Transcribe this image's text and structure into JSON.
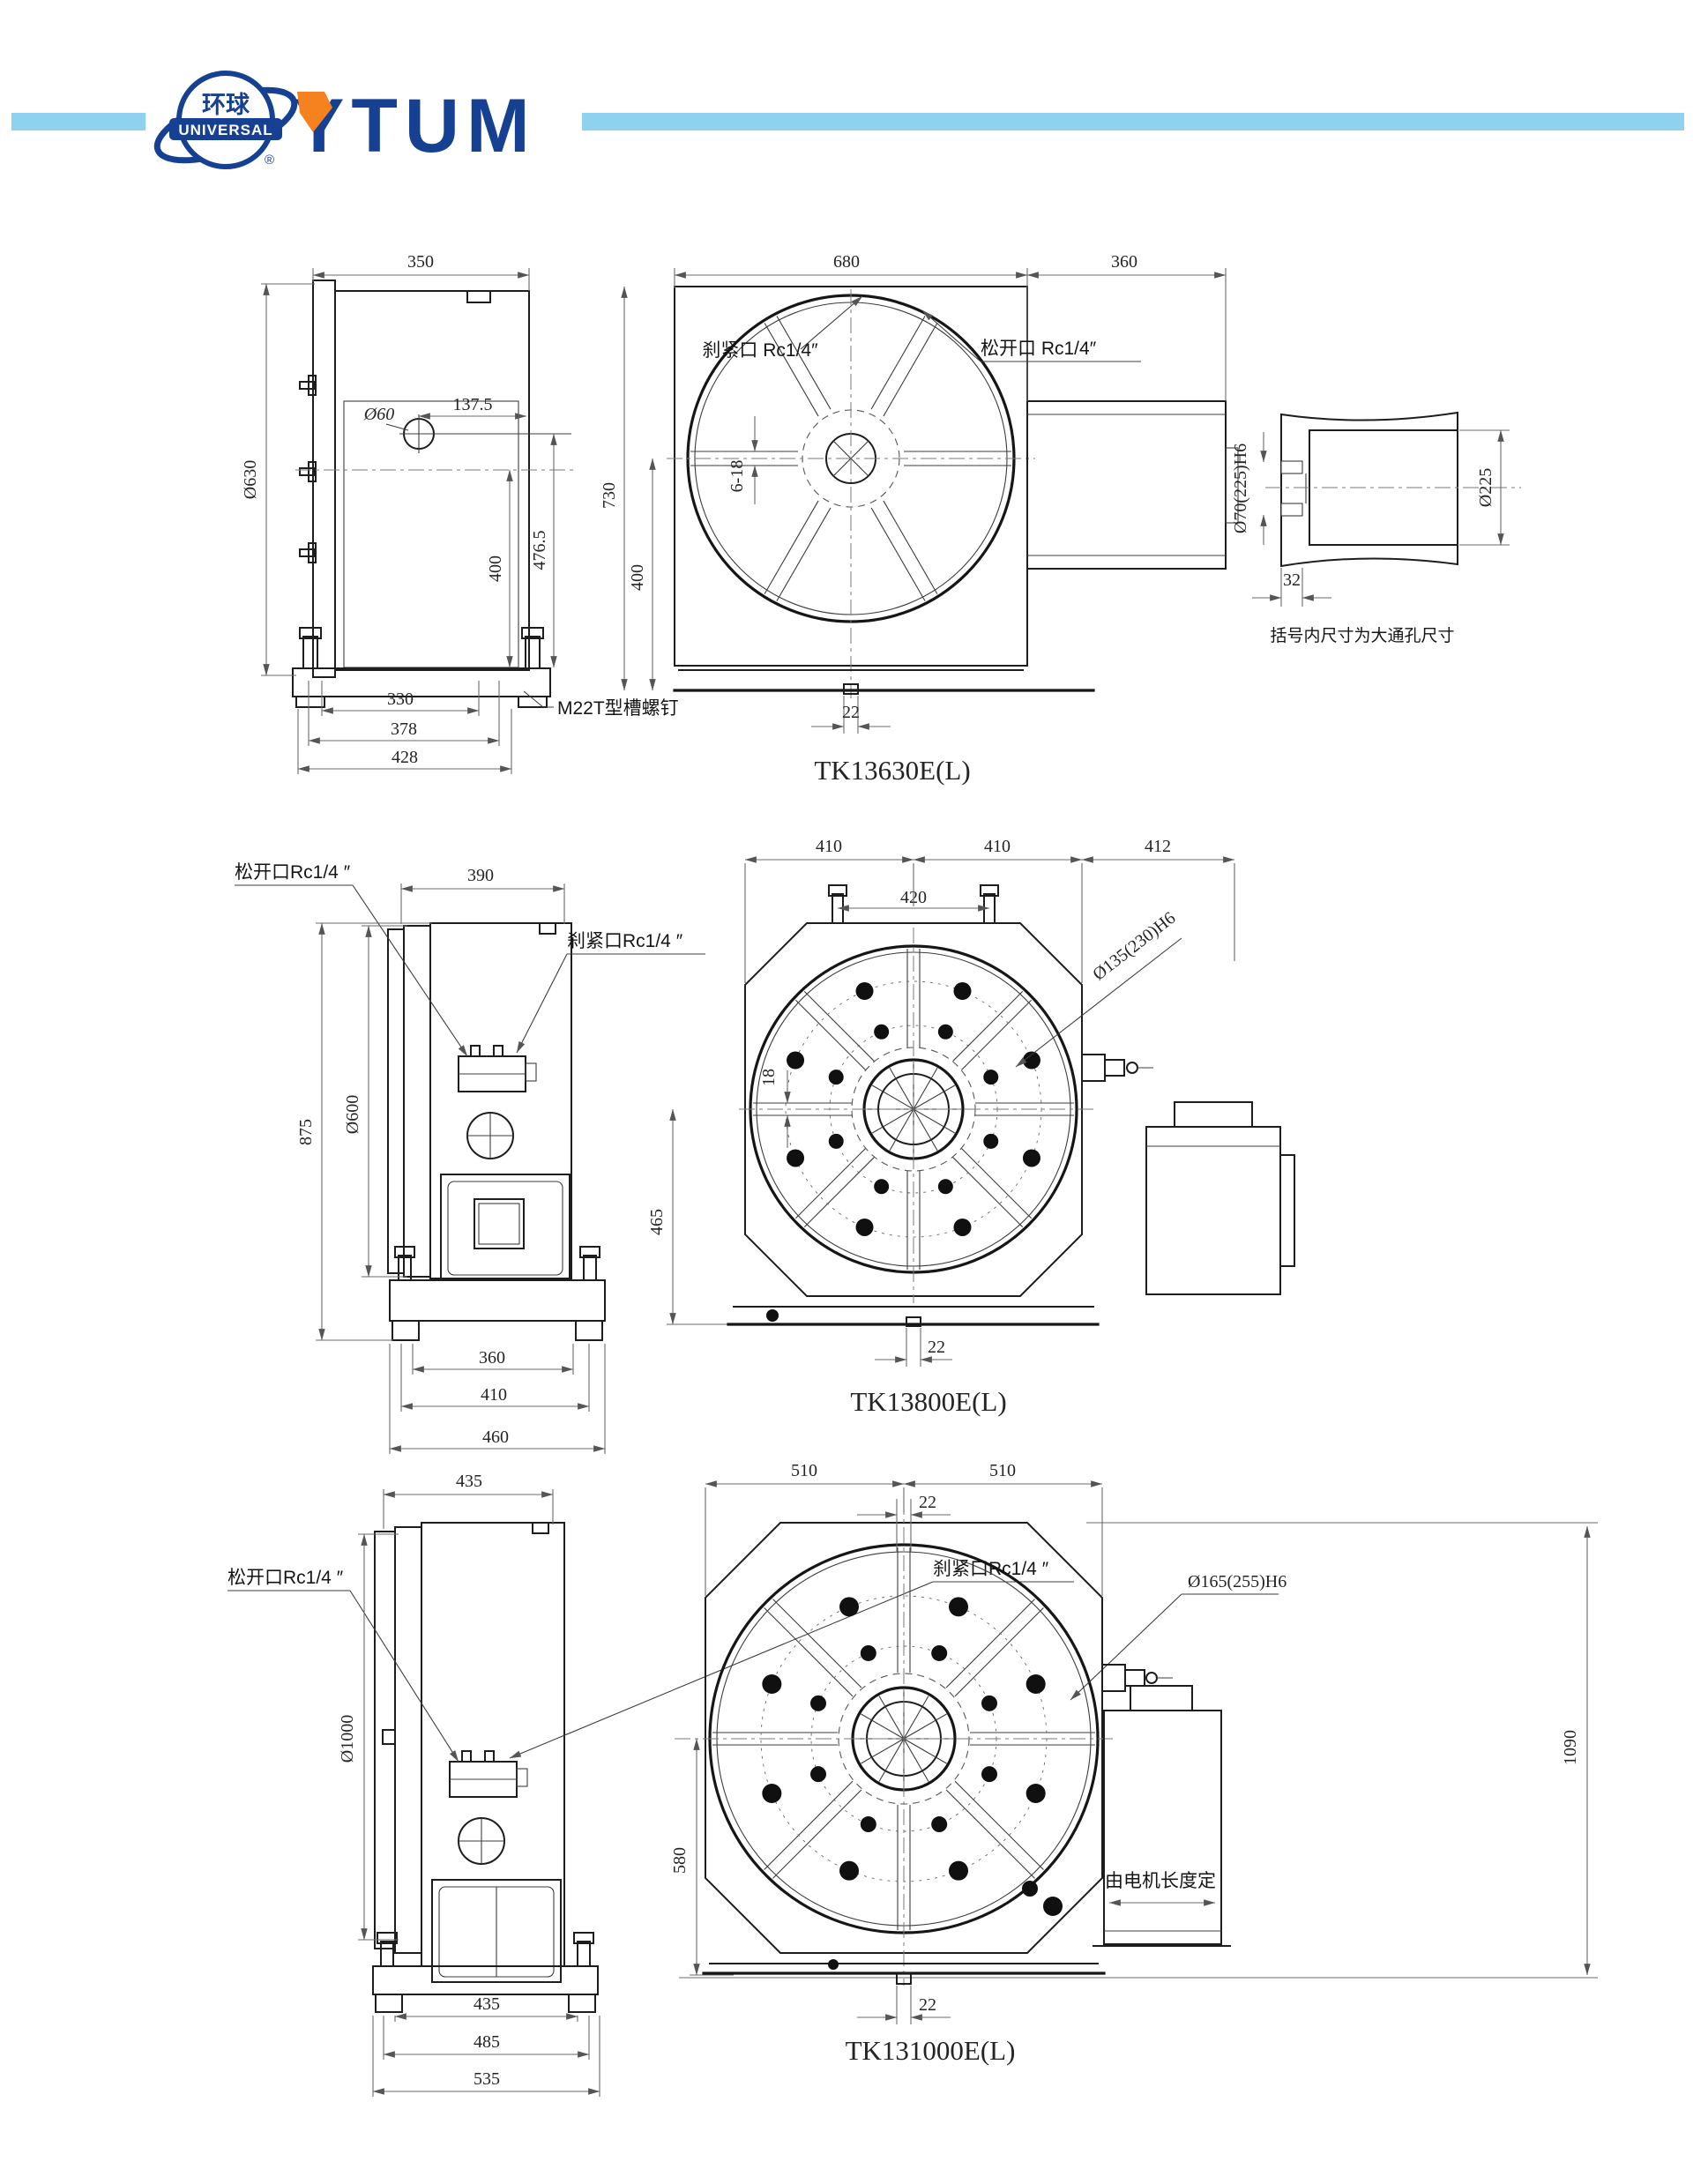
{
  "brand": {
    "logo_zh": "环球",
    "logo_en": "UNIVERSAL",
    "reg": "®",
    "wordmark": "YTUM",
    "colors": {
      "navy": "#164193",
      "orange": "#f5821f",
      "accent_bar": "#8ed2f0"
    }
  },
  "drawings": [
    {
      "model": "TK13630E(L)",
      "side": {
        "width_top": "350",
        "offset": "137.5",
        "hole": "Ø60",
        "face_dia": "Ø630",
        "h1": "400",
        "h2": "476.5",
        "base1": "330",
        "base2": "378",
        "base3": "428",
        "tslot_note": "M22T型槽螺钉"
      },
      "front": {
        "w1": "680",
        "w2": "360",
        "h1": "730",
        "h2": "400",
        "slots": "6-18",
        "clamp": "刹紧口 Rc1/4″",
        "release": "松开口 Rc1/4″",
        "key": "22"
      },
      "bore": {
        "bore_dia": "Ø70(225)H6",
        "outer_dia": "Ø225",
        "depth": "32",
        "note": "括号内尺寸为大通孔尺寸"
      }
    },
    {
      "model": "TK13800E(L)",
      "side": {
        "width_top": "390",
        "release": "松开口Rc1/4 ″",
        "clamp": "刹紧口Rc1/4 ″",
        "height": "875",
        "face_dia": "Ø600",
        "base1": "360",
        "base2": "410",
        "base3": "460"
      },
      "front": {
        "w1": "410",
        "w2": "410",
        "w3": "412",
        "w4": "420",
        "bore_dia": "Ø135(230)H6",
        "slot": "18",
        "h1": "465",
        "key": "22"
      }
    },
    {
      "model": "TK131000E(L)",
      "side": {
        "width_top": "435",
        "release": "松开口Rc1/4 ″",
        "clamp": "刹紧口Rc1/4 ″",
        "face_dia": "Ø1000",
        "base1": "435",
        "base2": "485",
        "base3": "535"
      },
      "front": {
        "w1": "510",
        "w2": "510",
        "key_top": "22",
        "bore_dia": "Ø165(255)H6",
        "h1": "580",
        "h2": "1090",
        "motor_note": "由电机长度定",
        "key_bottom": "22"
      }
    }
  ]
}
